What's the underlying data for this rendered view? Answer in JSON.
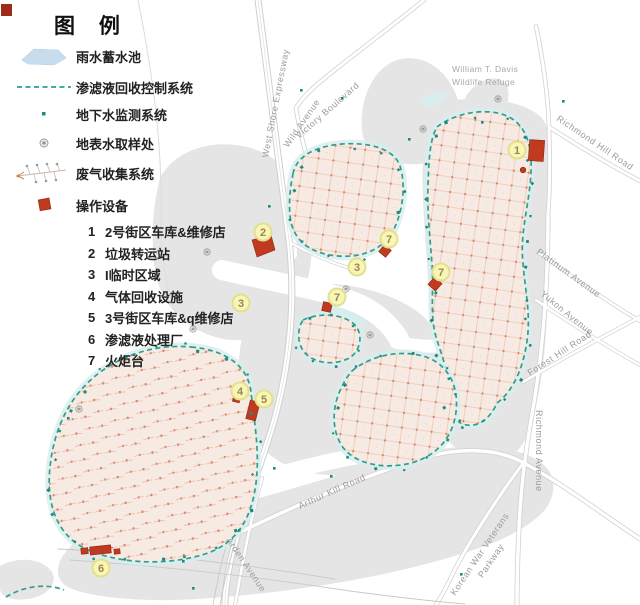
{
  "legend": {
    "title": "图 例",
    "items": [
      {
        "icon": "pond-icon",
        "label": "雨水蓄水池"
      },
      {
        "icon": "dashed-line-icon",
        "label": "渗滤液回收控制系统"
      },
      {
        "icon": "dot-icon",
        "label": "地下水监测系统"
      },
      {
        "icon": "sampling-icon",
        "label": "地表水取样处"
      },
      {
        "icon": "gas-collection-icon",
        "label": "废气收集系统"
      },
      {
        "icon": "equipment-icon",
        "label": "操作设备"
      }
    ],
    "equipment_list": [
      {
        "num": "1",
        "label": "2号街区车库&维修店"
      },
      {
        "num": "2",
        "label": "垃圾转运站"
      },
      {
        "num": "3",
        "label": "I临时区域"
      },
      {
        "num": "4",
        "label": "气体回收设施"
      },
      {
        "num": "5",
        "label": "3号街区车库&q维修店"
      },
      {
        "num": "6",
        "label": "渗滤液处理厂"
      },
      {
        "num": "7",
        "label": "火炬台"
      }
    ]
  },
  "map": {
    "area_labels": {
      "wildlife_refuge_line1": "William T. Davis",
      "wildlife_refuge_line2": "Wildlife Refuge"
    },
    "road_labels": {
      "west_shore": "West Shore Expressway",
      "victory": "Victory Boulevard",
      "wild": "Wild Avenue",
      "richmond_hill": "Richmond Hill Road",
      "platinum": "Platinum Avenue",
      "yukon": "Yukon Avenue",
      "forest_hill": "Forest Hill Road",
      "richmond": "Richmond Avenue",
      "arthur_kill": "Arthur Kill Road",
      "arden": "Arden Avenue",
      "korean_line1": "Korean War Veterans",
      "korean_line2": "Parkway"
    },
    "markers": [
      {
        "label": "1"
      },
      {
        "label": "2"
      },
      {
        "label": "3"
      },
      {
        "label": "3"
      },
      {
        "label": "4"
      },
      {
        "label": "5"
      },
      {
        "label": "6"
      },
      {
        "label": "7"
      },
      {
        "label": "7"
      },
      {
        "label": "7"
      }
    ]
  },
  "colors": {
    "outline_teal": "#2f9e8e",
    "monitor_dot": "#1d8a80",
    "equipment_red": "#bf3a1f",
    "mound_fill": "#f7eae3",
    "texture_orange": "#d3835f",
    "water_blue": "#d9edef",
    "land_gray": "#e5e5e5",
    "marker_fill": "#f8f5b6",
    "marker_border": "#e3e08d",
    "road_label_gray": "#9b9b9b"
  }
}
